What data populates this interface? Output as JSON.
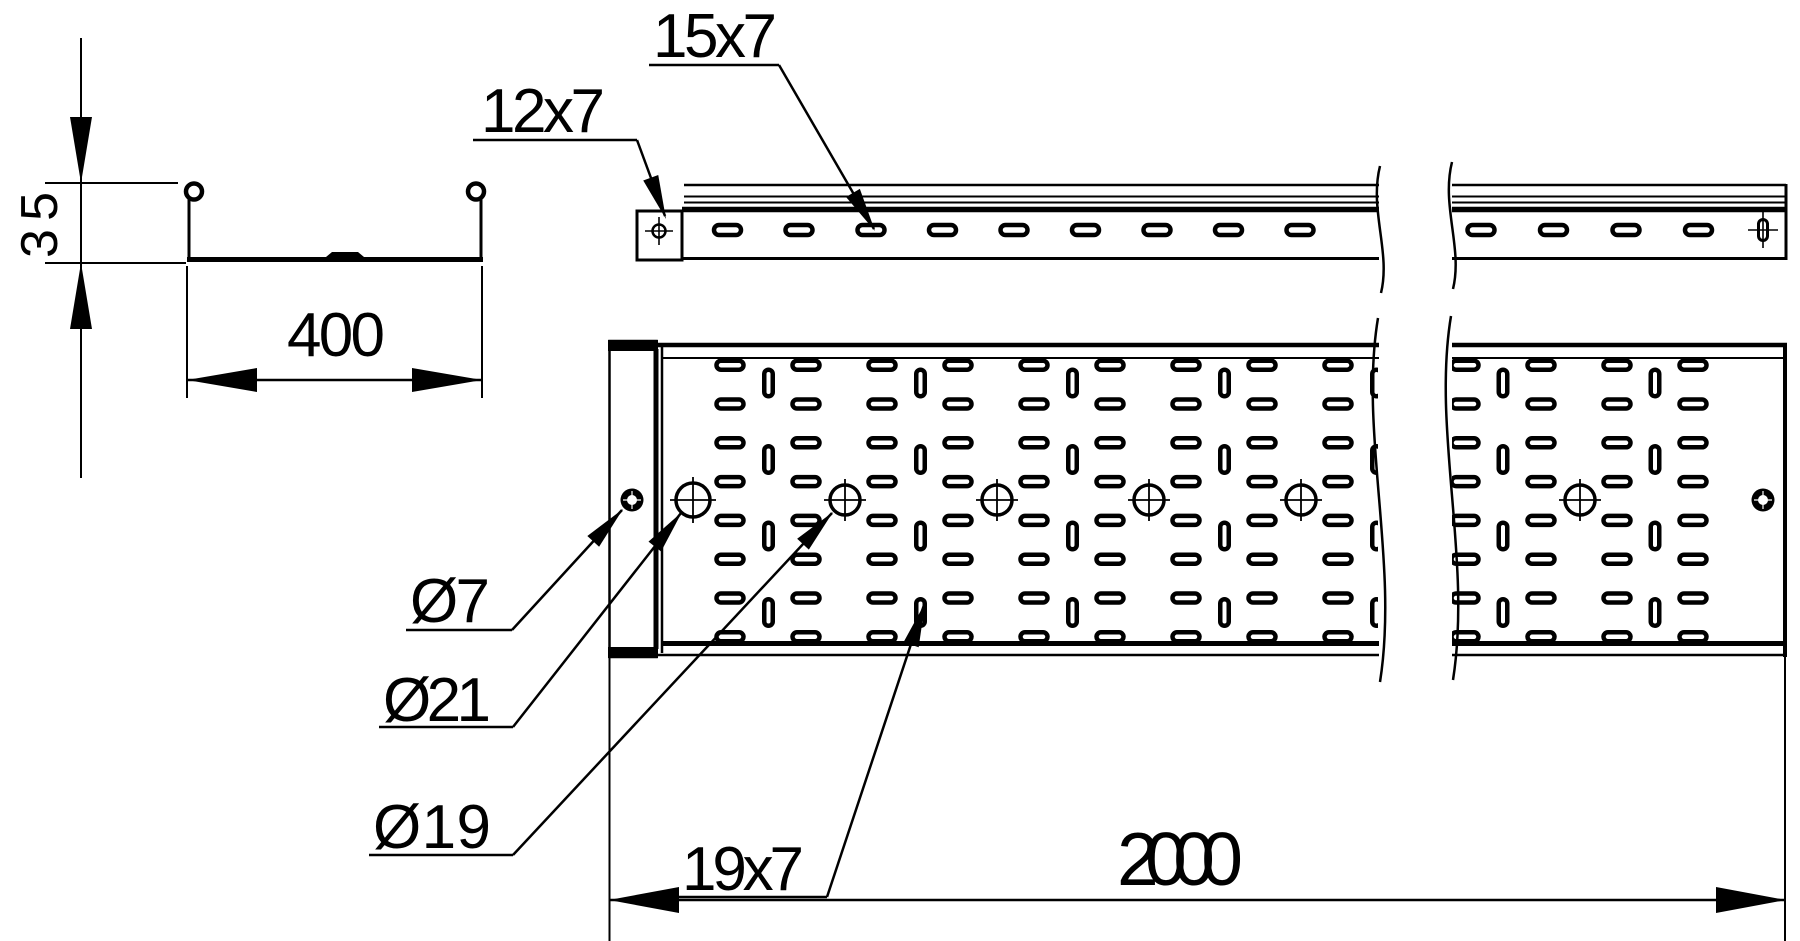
{
  "drawing": {
    "title": "perforated cable tray drawing",
    "background": "#ffffff",
    "line_color": "#000000",
    "labels": {
      "section_height": "35",
      "section_width": "400",
      "end_plate_slot": "12x7",
      "side_rail_slot": "15x7",
      "rivet_hole": "Ø7",
      "large_center_hole": "Ø21",
      "center_hole": "Ø19",
      "floor_slot": "19x7",
      "overall_length": "2000"
    }
  }
}
